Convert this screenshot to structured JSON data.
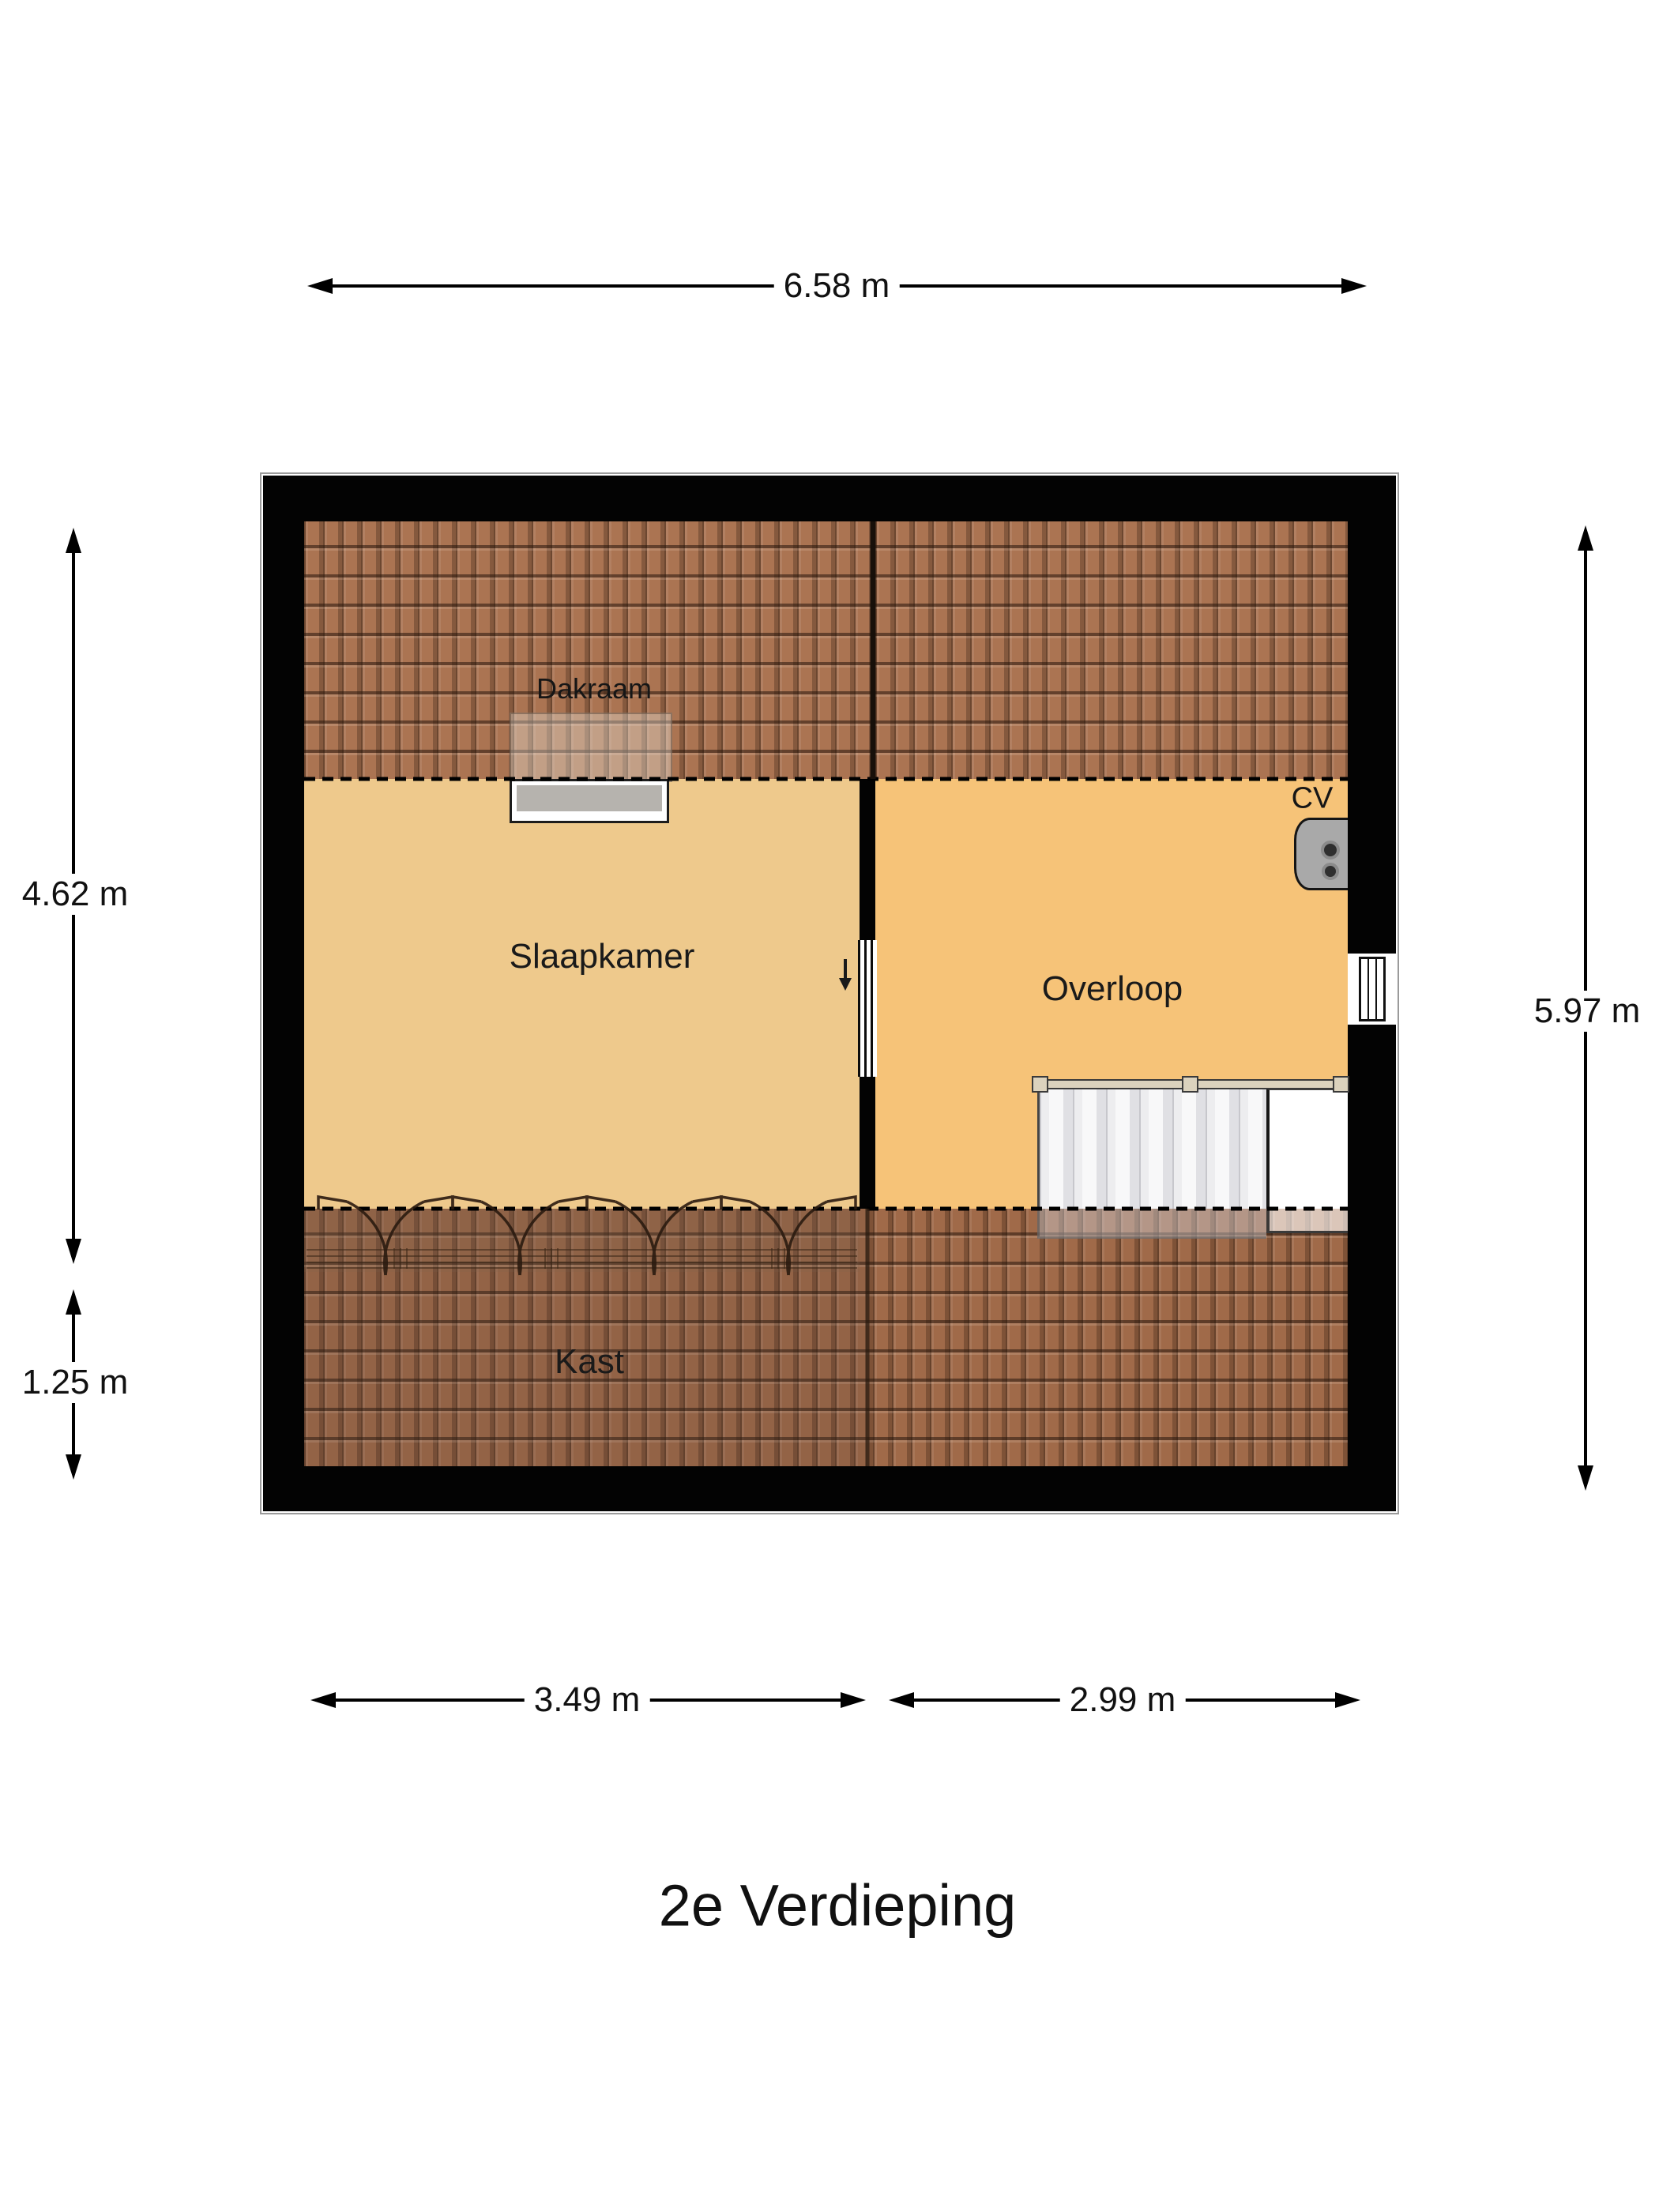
{
  "title": "2e Verdieping",
  "rooms": {
    "slaapkamer": "Slaapkamer",
    "overloop": "Overloop",
    "kast": "Kast"
  },
  "features": {
    "dakraam": "Dakraam",
    "cv": "CV"
  },
  "dimensions": {
    "top": "6.58 m",
    "left_upper": "4.62 m",
    "left_lower": "1.25 m",
    "right": "5.97 m",
    "bottom_left": "3.49 m",
    "bottom_right": "2.99 m"
  },
  "colors": {
    "wall": "#000000",
    "floor_slaapkamer": "#eec98c",
    "floor_overloop": "#f6c378",
    "roof_tile": "#ab7452",
    "roof_tile_seam": "#5d3a24",
    "stairs": "#ececee",
    "stairs_rail": "#dbd2bd",
    "cv_unit": "#a9a9a9",
    "dimension_text": "#111111"
  }
}
